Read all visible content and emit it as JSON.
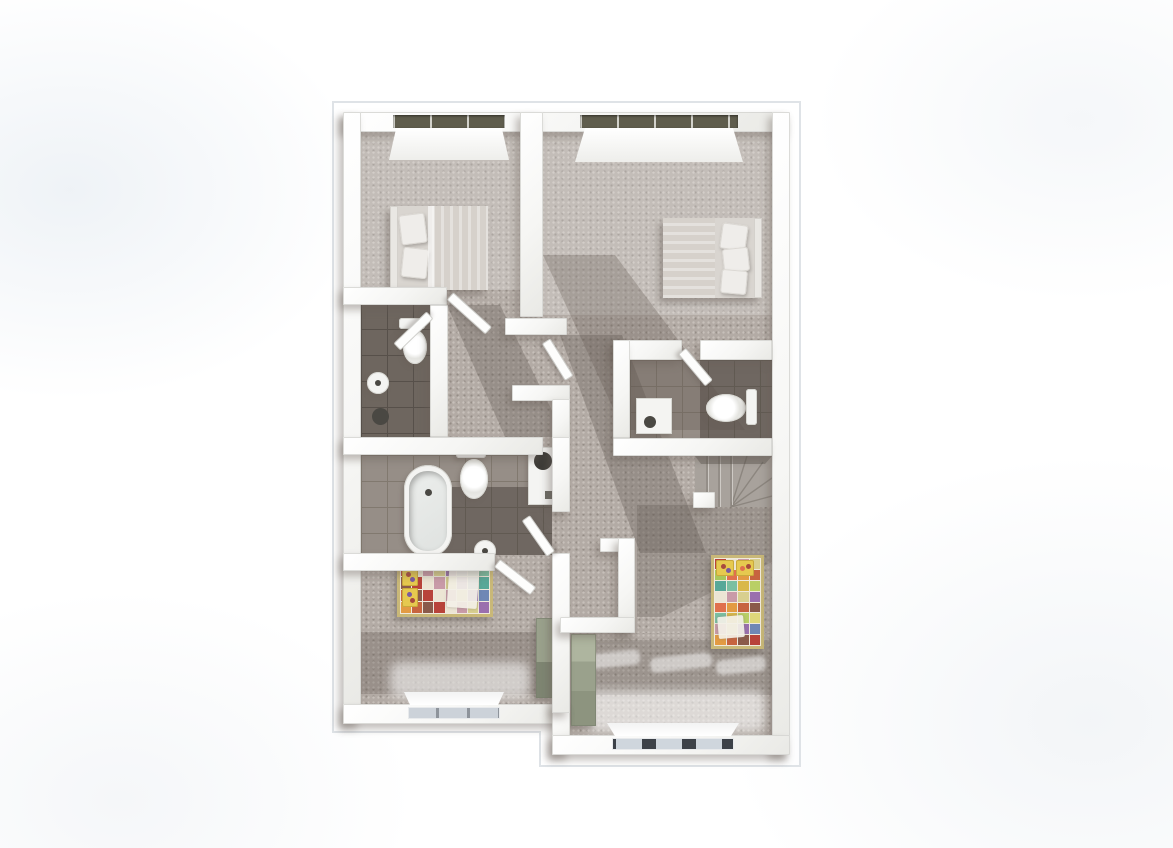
{
  "scene": {
    "kind": "architectural-floor-plan-3d-render",
    "view": "top-down dollhouse view of an upper floor",
    "background": "#ffffff",
    "no_visible_text": true
  },
  "palette": {
    "carpet": "#b3aba5",
    "carpet-dot": "#c7c0ba",
    "tile": "#968e87",
    "tile-line": "#81796f",
    "window-dark": "#5f5d4d",
    "window-light": "#ccd2d9",
    "fixture": "#f4f4f2",
    "bed-duvet": "#d6d1cb",
    "bed-pillow": "#efedea",
    "quilt-frame": "#c9b878",
    "kids-pillow": "#e6c94f",
    "kids-pillow-dot": "#a84a3e",
    "wardrobe-light": "#aab29c",
    "wardrobe-dark": "#7e8572",
    "stair-tread": "#a8a29c",
    "shadow": "rgba(93,84,77,0.32)"
  },
  "rooms": [
    {
      "id": "bedroom-top-left",
      "furniture": [
        "double-bed",
        "window-top"
      ]
    },
    {
      "id": "bedroom-top-right",
      "furniture": [
        "double-bed",
        "window-top"
      ]
    },
    {
      "id": "wc-left",
      "furniture": [
        "toilet",
        "round-sink",
        "waste-bin"
      ]
    },
    {
      "id": "bathroom-main",
      "furniture": [
        "oval-bathtub",
        "toilet",
        "shower-tray",
        "round-sink"
      ]
    },
    {
      "id": "bathroom-right",
      "furniture": [
        "toilet",
        "shower-tray"
      ]
    },
    {
      "id": "stairwell",
      "furniture": [
        "winder-staircase"
      ]
    },
    {
      "id": "kids-room-left",
      "furniture": [
        "patchwork-single-bed",
        "wardrobe-green",
        "window-bottom"
      ]
    },
    {
      "id": "kids-room-right-entry",
      "furniture": [
        "patchwork-single-bed",
        "wardrobe-green",
        "window-bottom",
        "sunlight-streaks"
      ]
    }
  ],
  "quilt": {
    "colors": [
      "#b8433a",
      "#e39b43",
      "#ded77a",
      "#7bbfa2",
      "#9a6fae",
      "#ece5d4",
      "#c7643f",
      "#a9c75b",
      "#d9b84a",
      "#6f87b5",
      "#c99ba8",
      "#8a5a4a",
      "#e0704d",
      "#b9cf66",
      "#58a898",
      "#d8cf8f"
    ],
    "sheet": "#f0ece0",
    "pillow": "#e6c94f"
  }
}
